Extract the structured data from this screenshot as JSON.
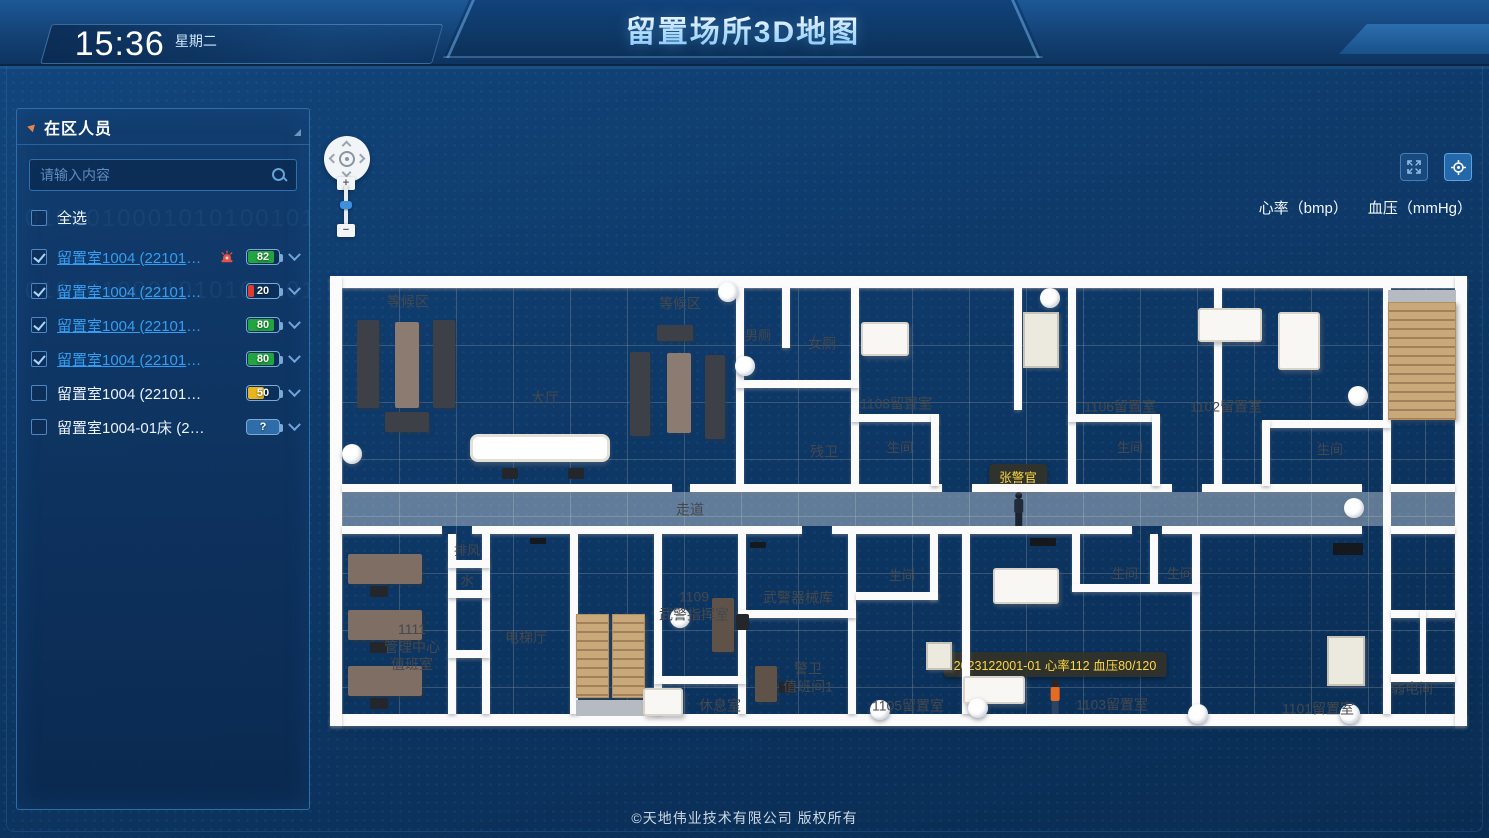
{
  "header": {
    "time": "15:36",
    "weekday": "星期二",
    "title": "留置场所3D地图"
  },
  "sidebar": {
    "title": "在区人员",
    "search_placeholder": "请输入内容",
    "select_all": "全选",
    "items": [
      {
        "label": "留置室1004 (22101315002)",
        "checked": true,
        "alarm": true,
        "value": "82",
        "level": "high"
      },
      {
        "label": "留置室1004 (22101315002)",
        "checked": true,
        "alarm": false,
        "value": "20",
        "level": "low"
      },
      {
        "label": "留置室1004 (22101315002)",
        "checked": true,
        "alarm": false,
        "value": "80",
        "level": "high"
      },
      {
        "label": "留置室1004 (22101315002)",
        "checked": true,
        "alarm": false,
        "value": "80",
        "level": "high"
      },
      {
        "label": "留置室1004 (22101315002)",
        "checked": false,
        "alarm": false,
        "value": "50",
        "level": "mid"
      },
      {
        "label": "留置室1004-01床 (22101315...",
        "checked": false,
        "alarm": false,
        "value": "?",
        "level": "unknown"
      }
    ]
  },
  "map": {
    "legend_heart": "心率（bmp）",
    "legend_bp": "血压（mmHg）",
    "zoom_in": "+",
    "zoom_out": "−",
    "officer_label": "张警官",
    "detainee_tooltip": "2023122001-01  心率112  血压80/120",
    "floorplan": {
      "walls": [
        [
          0,
          14,
          1137,
          12
        ],
        [
          0,
          452,
          1137,
          12
        ],
        [
          0,
          14,
          12,
          450
        ],
        [
          1125,
          14,
          12,
          450
        ],
        [
          406,
          26,
          8,
          198
        ],
        [
          521,
          26,
          8,
          198
        ],
        [
          684,
          26,
          8,
          122
        ],
        [
          738,
          26,
          8,
          198
        ],
        [
          884,
          26,
          8,
          198
        ],
        [
          1053,
          26,
          8,
          426
        ],
        [
          12,
          222,
          330,
          8
        ],
        [
          360,
          222,
          252,
          8
        ],
        [
          642,
          222,
          200,
          8
        ],
        [
          872,
          222,
          160,
          8
        ],
        [
          1061,
          222,
          64,
          8
        ],
        [
          12,
          264,
          100,
          8
        ],
        [
          142,
          264,
          330,
          8
        ],
        [
          502,
          264,
          300,
          8
        ],
        [
          832,
          264,
          200,
          8
        ],
        [
          1061,
          264,
          64,
          8
        ],
        [
          452,
          26,
          8,
          60
        ],
        [
          406,
          118,
          123,
          8
        ],
        [
          521,
          152,
          88,
          8
        ],
        [
          601,
          152,
          8,
          72
        ],
        [
          738,
          152,
          92,
          8
        ],
        [
          822,
          152,
          8,
          72
        ],
        [
          932,
          158,
          129,
          8
        ],
        [
          932,
          158,
          8,
          66
        ],
        [
          118,
          272,
          8,
          180
        ],
        [
          152,
          272,
          8,
          180
        ],
        [
          240,
          272,
          8,
          180
        ],
        [
          324,
          272,
          8,
          180
        ],
        [
          408,
          272,
          8,
          84
        ],
        [
          408,
          348,
          8,
          104
        ],
        [
          518,
          272,
          8,
          180
        ],
        [
          632,
          272,
          8,
          180
        ],
        [
          862,
          272,
          8,
          180
        ],
        [
          118,
          298,
          42,
          8
        ],
        [
          118,
          328,
          42,
          8
        ],
        [
          118,
          388,
          42,
          8
        ],
        [
          324,
          414,
          92,
          8
        ],
        [
          408,
          348,
          118,
          8
        ],
        [
          600,
          272,
          8,
          66
        ],
        [
          526,
          330,
          82,
          8
        ],
        [
          742,
          272,
          8,
          56
        ],
        [
          820,
          272,
          8,
          56
        ],
        [
          742,
          322,
          128,
          8
        ],
        [
          1061,
          348,
          64,
          8
        ],
        [
          1090,
          348,
          6,
          64
        ],
        [
          1061,
          412,
          64,
          8
        ]
      ],
      "labels": [
        {
          "text": "等候区",
          "x": 78,
          "y": 40
        },
        {
          "text": "等候区",
          "x": 350,
          "y": 42
        },
        {
          "text": "大厅",
          "x": 215,
          "y": 136
        },
        {
          "text": "走道",
          "x": 360,
          "y": 248
        },
        {
          "text": "男厕",
          "x": 428,
          "y": 74,
          "s": 1
        },
        {
          "text": "女厕",
          "x": 492,
          "y": 82
        },
        {
          "text": "残卫",
          "x": 494,
          "y": 190
        },
        {
          "text": "1108留置室",
          "x": 566,
          "y": 142
        },
        {
          "text": "生间",
          "x": 570,
          "y": 186,
          "s": 1
        },
        {
          "text": "1106留置室",
          "x": 790,
          "y": 145
        },
        {
          "text": "生间",
          "x": 800,
          "y": 186,
          "s": 1
        },
        {
          "text": "1102留置室",
          "x": 896,
          "y": 145
        },
        {
          "text": "生间",
          "x": 1000,
          "y": 188,
          "s": 1
        },
        {
          "text": "1111\n管理中心\n值班室",
          "x": 82,
          "y": 385
        },
        {
          "text": "排风",
          "x": 137,
          "y": 289,
          "s": 1
        },
        {
          "text": "水",
          "x": 137,
          "y": 319,
          "s": 1
        },
        {
          "text": "电梯厅",
          "x": 196,
          "y": 376
        },
        {
          "text": "1109\n武警指挥室",
          "x": 364,
          "y": 344
        },
        {
          "text": "休息室",
          "x": 390,
          "y": 444
        },
        {
          "text": "武警器械库",
          "x": 468,
          "y": 336
        },
        {
          "text": "警卫\n值班间1",
          "x": 478,
          "y": 416
        },
        {
          "text": "1105留置室",
          "x": 578,
          "y": 444
        },
        {
          "text": "生间",
          "x": 572,
          "y": 314,
          "s": 1
        },
        {
          "text": "1103留置室",
          "x": 782,
          "y": 443
        },
        {
          "text": "生间",
          "x": 795,
          "y": 312,
          "s": 1
        },
        {
          "text": "生间",
          "x": 850,
          "y": 312,
          "s": 1
        },
        {
          "text": "1101留置室",
          "x": 988,
          "y": 447
        },
        {
          "text": "弱电间",
          "x": 1082,
          "y": 427
        }
      ],
      "furniture": [
        {
          "t": "bench",
          "r": [
            27,
            58,
            22,
            88
          ]
        },
        {
          "t": "table",
          "r": [
            65,
            60,
            24,
            86
          ]
        },
        {
          "t": "bench",
          "r": [
            103,
            58,
            22,
            88
          ]
        },
        {
          "t": "bench",
          "r": [
            55,
            150,
            44,
            20
          ]
        },
        {
          "t": "bench",
          "r": [
            327,
            63,
            36,
            16
          ]
        },
        {
          "t": "bench",
          "r": [
            300,
            90,
            20,
            84
          ]
        },
        {
          "t": "table",
          "r": [
            337,
            91,
            24,
            80
          ]
        },
        {
          "t": "bench",
          "r": [
            375,
            93,
            20,
            84
          ]
        },
        {
          "t": "counter",
          "r": [
            140,
            172,
            140,
            28
          ]
        },
        {
          "t": "stool",
          "r": [
            172,
            206,
            16,
            11
          ]
        },
        {
          "t": "stool",
          "r": [
            238,
            206,
            16,
            11
          ]
        },
        {
          "t": "bed",
          "r": [
            531,
            60,
            48,
            34
          ]
        },
        {
          "t": "cabinet",
          "r": [
            693,
            50,
            36,
            56
          ]
        },
        {
          "t": "bed",
          "r": [
            868,
            46,
            64,
            34
          ]
        },
        {
          "t": "bed",
          "r": [
            948,
            50,
            42,
            58
          ]
        },
        {
          "t": "desk",
          "r": [
            18,
            292,
            74,
            30
          ]
        },
        {
          "t": "chair",
          "r": [
            40,
            324,
            18,
            11
          ]
        },
        {
          "t": "desk",
          "r": [
            18,
            348,
            74,
            30
          ]
        },
        {
          "t": "chair",
          "r": [
            40,
            380,
            18,
            11
          ]
        },
        {
          "t": "desk",
          "r": [
            18,
            404,
            74,
            30
          ]
        },
        {
          "t": "chair",
          "r": [
            40,
            436,
            18,
            11
          ]
        },
        {
          "t": "stairs",
          "r": [
            246,
            352,
            33,
            84
          ]
        },
        {
          "t": "stairs",
          "r": [
            282,
            352,
            33,
            84
          ]
        },
        {
          "t": "landing",
          "r": [
            246,
            438,
            70,
            16
          ]
        },
        {
          "t": "deskv",
          "r": [
            382,
            336,
            22,
            54
          ]
        },
        {
          "t": "chair",
          "r": [
            406,
            352,
            13,
            16
          ]
        },
        {
          "t": "bed",
          "r": [
            313,
            426,
            40,
            28
          ]
        },
        {
          "t": "deskv",
          "r": [
            425,
            404,
            22,
            36
          ]
        },
        {
          "t": "chair",
          "r": [
            449,
            420,
            16,
            11
          ]
        },
        {
          "t": "cabinet",
          "r": [
            596,
            380,
            26,
            28
          ]
        },
        {
          "t": "bed",
          "r": [
            633,
            414,
            62,
            28
          ]
        },
        {
          "t": "bed",
          "r": [
            663,
            306,
            66,
            36
          ]
        },
        {
          "t": "cabinet",
          "r": [
            997,
            374,
            38,
            50
          ]
        },
        {
          "t": "stairs",
          "r": [
            1058,
            40,
            68,
            118
          ]
        },
        {
          "t": "landing",
          "r": [
            1058,
            28,
            68,
            12
          ]
        },
        {
          "t": "tv",
          "r": [
            1003,
            281,
            30,
            12
          ]
        },
        {
          "t": "tv",
          "r": [
            700,
            276,
            26,
            8
          ]
        },
        {
          "t": "tv",
          "r": [
            420,
            280,
            16,
            6
          ]
        },
        {
          "t": "tv",
          "r": [
            200,
            276,
            16,
            6
          ]
        }
      ],
      "sensors": [
        [
          398,
          30
        ],
        [
          415,
          104
        ],
        [
          720,
          36
        ],
        [
          22,
          192
        ],
        [
          1028,
          134
        ],
        [
          1024,
          246
        ],
        [
          350,
          356
        ],
        [
          550,
          448
        ],
        [
          648,
          446
        ],
        [
          868,
          452
        ],
        [
          1020,
          452
        ]
      ]
    }
  },
  "footer": {
    "copyright": "©天地伟业技术有限公司 版权所有"
  },
  "decor": {
    "binary": "01010100010101001010101100101010010110100101"
  },
  "colors": {
    "accent_link": "#359cf0",
    "battery_high": "#21a53e",
    "battery_mid": "#e9b41f",
    "battery_low": "#e03b30",
    "alarm_red": "#e25048",
    "marker_text": "#ffd83d",
    "panel_border": "#2e6dab",
    "floor": "#ece9e3"
  }
}
